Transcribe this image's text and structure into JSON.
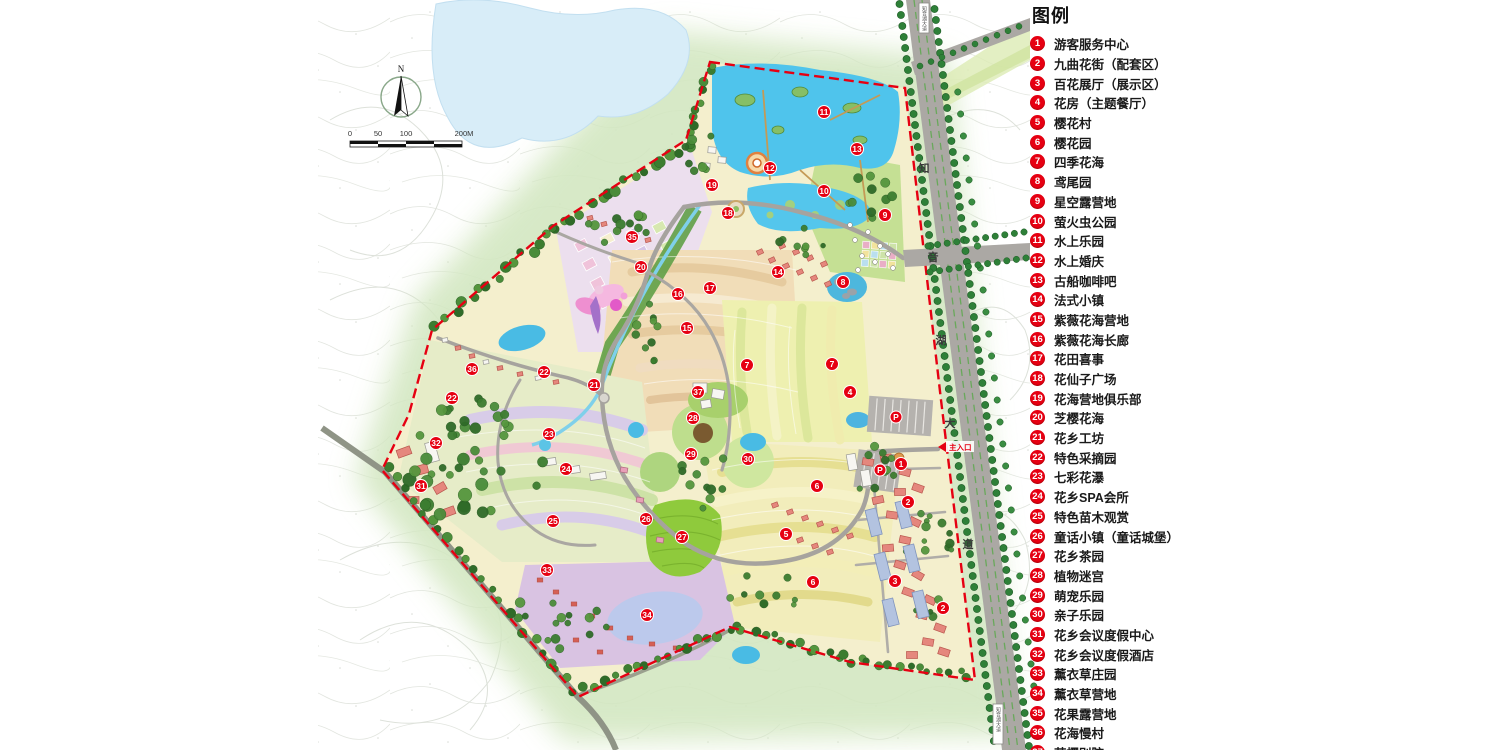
{
  "legend": {
    "title": "图例",
    "items": [
      {
        "num": "1",
        "label": "游客服务中心"
      },
      {
        "num": "2",
        "label": "九曲花街（配套区）"
      },
      {
        "num": "3",
        "label": "百花展厅（展示区）"
      },
      {
        "num": "4",
        "label": "花房（主题餐厅）"
      },
      {
        "num": "5",
        "label": "樱花村"
      },
      {
        "num": "6",
        "label": "樱花园"
      },
      {
        "num": "7",
        "label": "四季花海"
      },
      {
        "num": "8",
        "label": "鸢尾园"
      },
      {
        "num": "9",
        "label": "星空露营地"
      },
      {
        "num": "10",
        "label": "萤火虫公园"
      },
      {
        "num": "11",
        "label": "水上乐园"
      },
      {
        "num": "12",
        "label": "水上婚庆"
      },
      {
        "num": "13",
        "label": "古船咖啡吧"
      },
      {
        "num": "14",
        "label": "法式小镇"
      },
      {
        "num": "15",
        "label": "紫薇花海营地"
      },
      {
        "num": "16",
        "label": "紫薇花海长廊"
      },
      {
        "num": "17",
        "label": "花田喜事"
      },
      {
        "num": "18",
        "label": "花仙子广场"
      },
      {
        "num": "19",
        "label": "花海营地俱乐部"
      },
      {
        "num": "20",
        "label": "芝樱花海"
      },
      {
        "num": "21",
        "label": "花乡工坊"
      },
      {
        "num": "22",
        "label": "特色采摘园"
      },
      {
        "num": "23",
        "label": "七彩花瀑"
      },
      {
        "num": "24",
        "label": "花乡SPA会所"
      },
      {
        "num": "25",
        "label": "特色苗木观赏"
      },
      {
        "num": "26",
        "label": "童话小镇（童话城堡）"
      },
      {
        "num": "27",
        "label": "花乡茶园"
      },
      {
        "num": "28",
        "label": "植物迷宫"
      },
      {
        "num": "29",
        "label": "萌宠乐园"
      },
      {
        "num": "30",
        "label": "亲子乐园"
      },
      {
        "num": "31",
        "label": "花乡会议度假中心"
      },
      {
        "num": "32",
        "label": "花乡会议度假酒店"
      },
      {
        "num": "33",
        "label": "薰衣草庄园"
      },
      {
        "num": "34",
        "label": "薰衣草营地"
      },
      {
        "num": "35",
        "label": "花果露营地"
      },
      {
        "num": "36",
        "label": "花海慢村"
      },
      {
        "num": "37",
        "label": "芝樱别院"
      }
    ]
  },
  "map": {
    "compass_label": "N",
    "scale_ticks": [
      "0",
      "50",
      "100",
      "200M"
    ],
    "road_name_chars": [
      {
        "ch": "知",
        "x": 924,
        "y": 172
      },
      {
        "ch": "音",
        "x": 933,
        "y": 261
      },
      {
        "ch": "湖",
        "x": 941,
        "y": 344
      },
      {
        "ch": "大",
        "x": 950,
        "y": 427
      },
      {
        "ch": "道",
        "x": 968,
        "y": 548
      }
    ],
    "road_sign_text": "知音湖大道",
    "entrance_label": "主入口",
    "parking_label": "P",
    "parking": [
      [
        896,
        417
      ],
      [
        880,
        470
      ]
    ],
    "markers": [
      {
        "n": "1",
        "x": 901,
        "y": 464
      },
      {
        "n": "2",
        "x": 908,
        "y": 502
      },
      {
        "n": "2",
        "x": 943,
        "y": 608
      },
      {
        "n": "3",
        "x": 895,
        "y": 581
      },
      {
        "n": "4",
        "x": 850,
        "y": 392
      },
      {
        "n": "5",
        "x": 786,
        "y": 534
      },
      {
        "n": "6",
        "x": 817,
        "y": 486
      },
      {
        "n": "6",
        "x": 813,
        "y": 582
      },
      {
        "n": "7",
        "x": 747,
        "y": 365
      },
      {
        "n": "7",
        "x": 832,
        "y": 364
      },
      {
        "n": "8",
        "x": 843,
        "y": 282
      },
      {
        "n": "9",
        "x": 885,
        "y": 215
      },
      {
        "n": "10",
        "x": 824,
        "y": 191
      },
      {
        "n": "11",
        "x": 824,
        "y": 112
      },
      {
        "n": "12",
        "x": 770,
        "y": 168
      },
      {
        "n": "13",
        "x": 857,
        "y": 149
      },
      {
        "n": "14",
        "x": 778,
        "y": 272
      },
      {
        "n": "15",
        "x": 687,
        "y": 328
      },
      {
        "n": "16",
        "x": 678,
        "y": 294
      },
      {
        "n": "17",
        "x": 710,
        "y": 288
      },
      {
        "n": "18",
        "x": 728,
        "y": 213
      },
      {
        "n": "19",
        "x": 712,
        "y": 185
      },
      {
        "n": "20",
        "x": 641,
        "y": 267
      },
      {
        "n": "21",
        "x": 594,
        "y": 385
      },
      {
        "n": "22",
        "x": 544,
        "y": 372
      },
      {
        "n": "22",
        "x": 452,
        "y": 398
      },
      {
        "n": "23",
        "x": 549,
        "y": 434
      },
      {
        "n": "24",
        "x": 566,
        "y": 469
      },
      {
        "n": "25",
        "x": 553,
        "y": 521
      },
      {
        "n": "26",
        "x": 646,
        "y": 519
      },
      {
        "n": "27",
        "x": 682,
        "y": 537
      },
      {
        "n": "28",
        "x": 693,
        "y": 418
      },
      {
        "n": "29",
        "x": 691,
        "y": 454
      },
      {
        "n": "30",
        "x": 748,
        "y": 459
      },
      {
        "n": "31",
        "x": 421,
        "y": 486
      },
      {
        "n": "32",
        "x": 436,
        "y": 443
      },
      {
        "n": "33",
        "x": 547,
        "y": 570
      },
      {
        "n": "34",
        "x": 647,
        "y": 615
      },
      {
        "n": "35",
        "x": 632,
        "y": 237
      },
      {
        "n": "36",
        "x": 472,
        "y": 369
      },
      {
        "n": "37",
        "x": 698,
        "y": 392
      }
    ],
    "colors": {
      "marker_red": "#e60012",
      "boundary_red": "#e60012",
      "lake_blue": "#4fc4ec",
      "road_gray": "#aba8a4",
      "halo_green": "#d3e7c1"
    }
  }
}
